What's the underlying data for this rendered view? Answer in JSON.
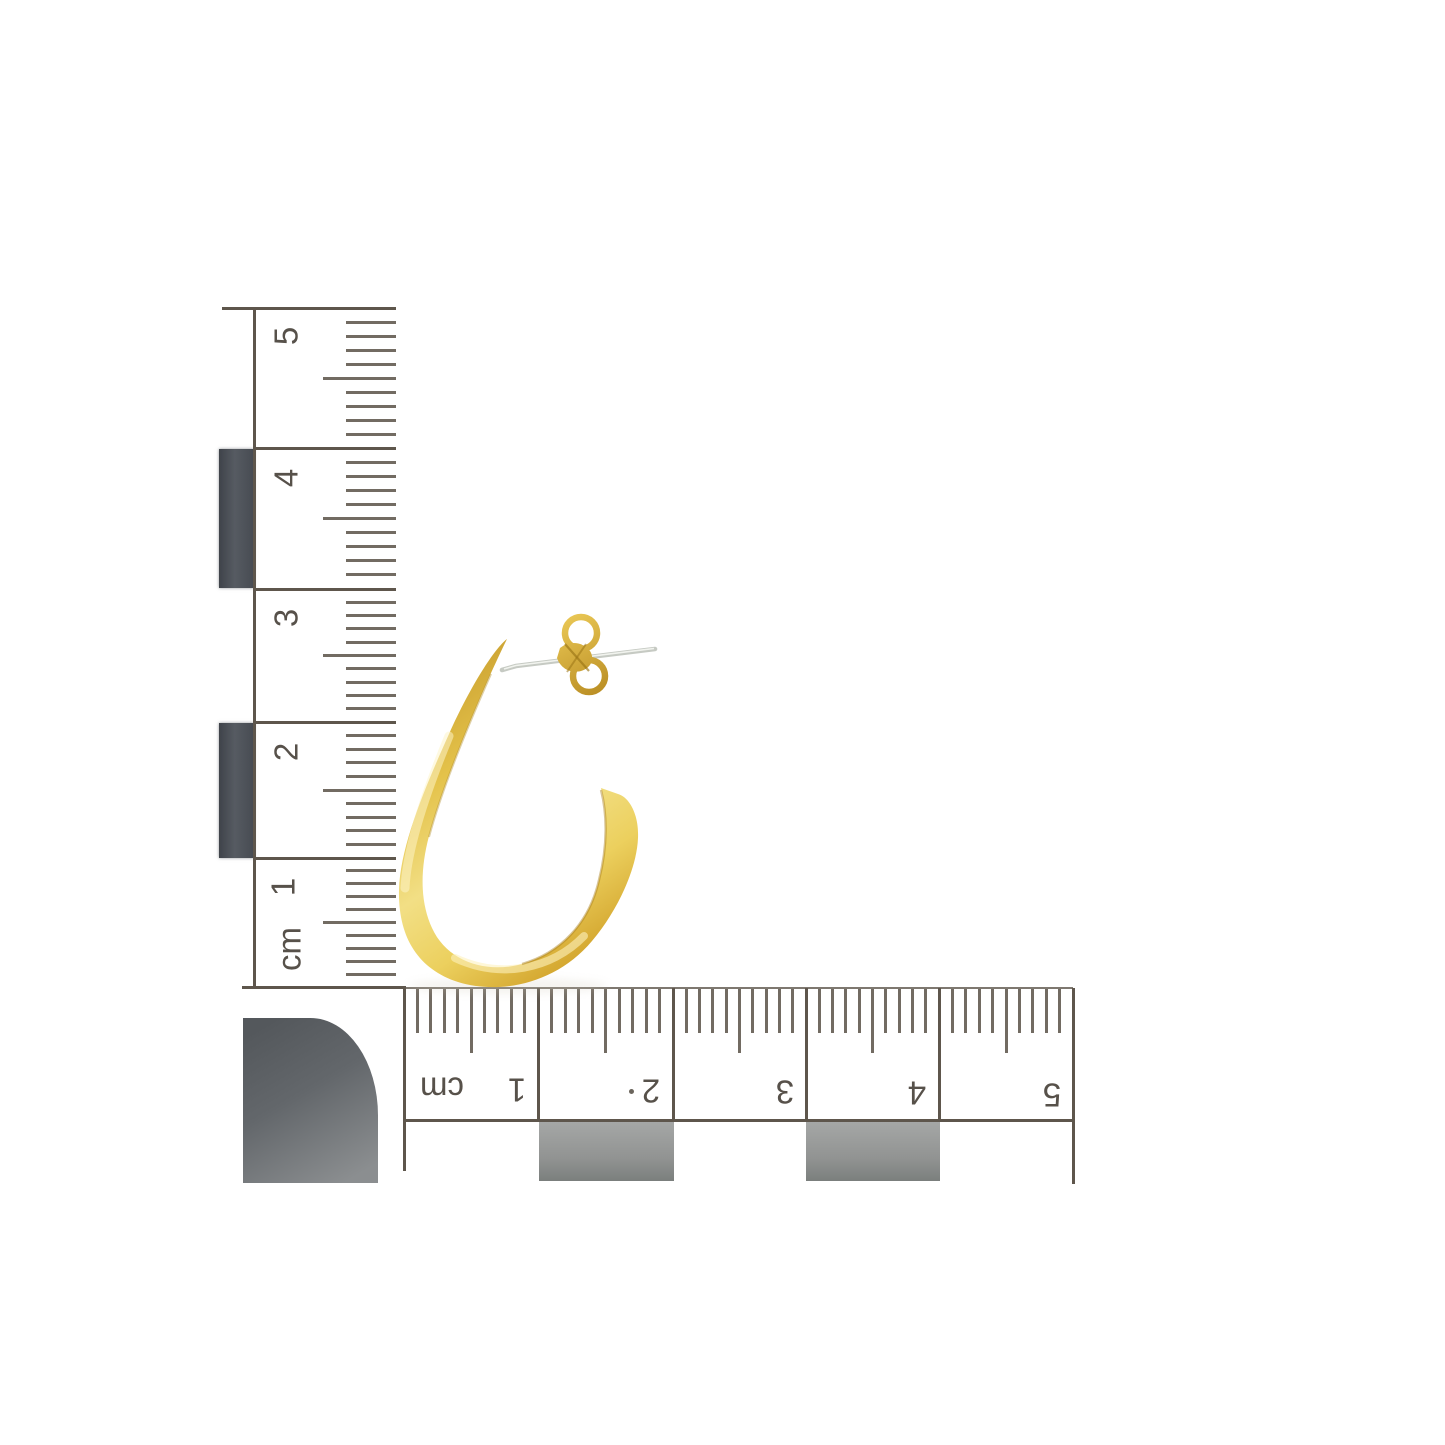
{
  "scene": {
    "type": "jewelry product photograph",
    "subject": "gold J-hoop stud earring with butterfly back shown against an L-shaped centimetre photo scale",
    "background_color": "#ffffff"
  },
  "vertical_ruler": {
    "unit": "cm",
    "labels": [
      "5",
      "4",
      "3",
      "2",
      "1",
      "cm"
    ],
    "cm_divisions": 5,
    "minor_ticks_per_cm": 10,
    "ink_color": "#5e564c",
    "block_color": "#464a51"
  },
  "horizontal_ruler": {
    "unit": "cm",
    "labels": [
      "cm",
      "1",
      "2",
      "3",
      "4",
      "5"
    ],
    "cm_divisions": 5,
    "minor_ticks_per_cm": 10,
    "ink_color": "#5e564c",
    "block_color": "#989a99"
  },
  "corner_marker": {
    "shape": "quarter-circle",
    "color": "#5d6164"
  },
  "earring": {
    "hoop": "polished gold open oval J-hoop",
    "post": "stud post",
    "back": "gold butterfly clutch with two round loops",
    "gold_color": "#e6c24a",
    "gold_highlight": "#f6e794",
    "gold_shadow": "#c1922a",
    "post_color": "#c6cac3"
  }
}
